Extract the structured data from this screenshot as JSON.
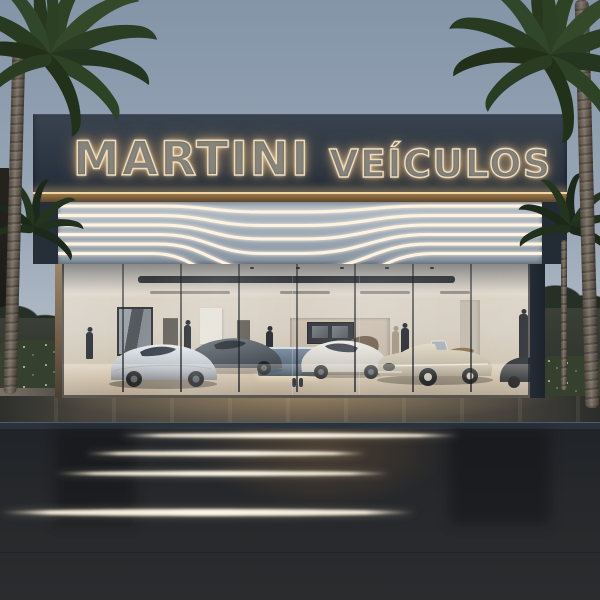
{
  "scene": {
    "type": "photorealistic architectural render",
    "time_of_day": "dusk",
    "description": "Modern luxury car dealership facade with glowing outline signage, a grey canopy band with six illuminated wave lines, and a full-width glass showroom displaying sports cars and a classic convertible, flanked by palm trees, reflected on a dark wet forecourt."
  },
  "sign": {
    "line1": "MARTINI",
    "line2": "VEÍCULOS"
  },
  "showroom": {
    "cars": [
      {
        "name": "silver-sports-car",
        "color": "#c9cdd3"
      },
      {
        "name": "dark-grey-sports-car",
        "color": "#4b5158"
      },
      {
        "name": "white-sports-car",
        "color": "#ded9cf"
      },
      {
        "name": "champagne-classic-convertible",
        "color": "#cdc3b0"
      },
      {
        "name": "bronze-car",
        "color": "#6b5744"
      },
      {
        "name": "black-classic-car",
        "color": "#26292d"
      }
    ],
    "people_count": 6
  },
  "colors": {
    "sky-top": "#8495a8",
    "sky-bottom": "#b9c1cb",
    "fascia": "#2d3743",
    "sign-stroke": "#f0ddba",
    "sign-glow": "#ffd9a6",
    "soffit-light": "#9a7848",
    "band-top": "#a2adb8",
    "band-bottom": "#8793a0",
    "wave-line": "#fdf3e0",
    "interior-wall": "#d8cfc2",
    "pillar": "#1c232b",
    "curb": "#2b323b",
    "asphalt": "#26282b",
    "streak": "#efe5d2",
    "hedge": "#35402f",
    "hedge-dot": "#aeb49b",
    "trunk": "#80766a",
    "suit": "#23262b",
    "beige": "#a2937e"
  }
}
